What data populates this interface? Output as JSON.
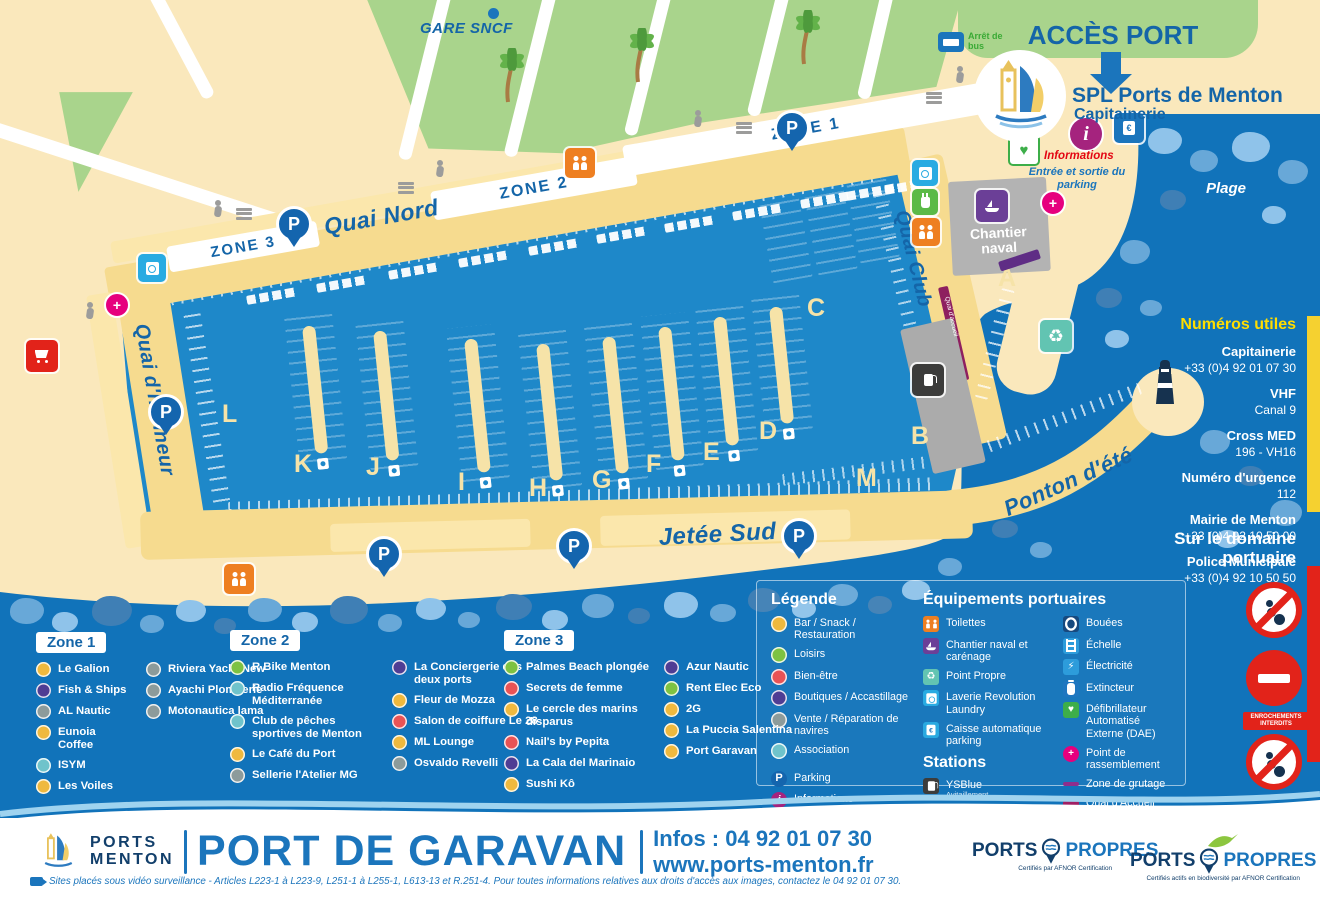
{
  "header": {
    "gare_sncf": "GARE SNCF",
    "acces_port": "ACCÈS PORT",
    "spl": "SPL Ports de Menton",
    "capitainerie": "Capitainerie",
    "arret_de_bus": "Arrêt de bus",
    "informations": "Informations",
    "entree_sortie": "Entrée et sortie du parking",
    "plage": "Plage"
  },
  "map": {
    "labels": {
      "quai_nord": "Quai Nord",
      "quai_honneur": "Quai d'honneur",
      "quai_club": "Quai Club",
      "jetee_sud": "Jetée Sud",
      "ponton_ete": "Ponton d'été",
      "chantier_naval": "Chantier naval",
      "quai_accueil": "Quai d'accueil",
      "zone1": "ZONE 1",
      "zone2": "ZONE 2",
      "zone3": "ZONE 3"
    },
    "pontoons": [
      "A",
      "B",
      "C",
      "D",
      "E",
      "F",
      "G",
      "H",
      "I",
      "J",
      "K",
      "L",
      "M"
    ]
  },
  "sidebar": {
    "numeros_utiles": {
      "title": "Numéros utiles",
      "entries": [
        {
          "label": "Capitainerie",
          "value": "+33 (0)4 92 01 07 30"
        },
        {
          "label": "VHF",
          "value": "Canal 9"
        },
        {
          "label": "Cross MED",
          "value": "196 - VH16"
        },
        {
          "label": "Numéro d'urgence",
          "value": "112"
        },
        {
          "label": "Mairie de Menton",
          "value": "+33 (0)4 92 10 50 00"
        },
        {
          "label": "Police Municipale",
          "value": "+33 (0)4 92 10 50 50"
        }
      ]
    },
    "domaine": {
      "title": "Sur le domaine portuaire",
      "signs": [
        {
          "name": "no-fishing",
          "label": ""
        },
        {
          "name": "no-entry",
          "label": "ENROCHEMENTS INTERDITS"
        },
        {
          "name": "no-rock-access",
          "label": ""
        }
      ]
    }
  },
  "category_colors": {
    "bar": "#EFB93E",
    "loisirs": "#7DC242",
    "bienetre": "#E95355",
    "boutiques": "#4F3D94",
    "vente": "#8C9B9B",
    "association": "#6FC3CB",
    "parking": "#1465AE",
    "info": "#A5237E"
  },
  "legend": {
    "title": "Légende",
    "categories": [
      {
        "label": "Bar / Snack / Restauration",
        "cat": "bar"
      },
      {
        "label": "Loisirs",
        "cat": "loisirs"
      },
      {
        "label": "Bien-être",
        "cat": "bienetre"
      },
      {
        "label": "Boutiques / Accastillage",
        "cat": "boutiques"
      },
      {
        "label": "Vente / Réparation de navires",
        "cat": "vente"
      },
      {
        "label": "Association",
        "cat": "association"
      }
    ],
    "extra": [
      {
        "label": "Parking",
        "type": "parking"
      },
      {
        "label": "Informations",
        "type": "info"
      },
      {
        "label": "Zone piétonne",
        "type": "pedestrian"
      }
    ],
    "equipements": {
      "title": "Équipements portuaires",
      "col1": [
        {
          "label": "Toilettes",
          "color": "#EE7F21",
          "icon": "toilets"
        },
        {
          "label": "Chantier naval et carénage",
          "color": "#6B3F97",
          "icon": "boat"
        },
        {
          "label": "Point Propre",
          "color": "#62C4B2",
          "icon": "recycle"
        },
        {
          "label": "Laverie Revolution Laundry",
          "color": "#29ABE2",
          "icon": "laundry"
        },
        {
          "label": "Caisse automatique parking",
          "color": "#2AA9E0",
          "icon": "card"
        }
      ],
      "col2": [
        {
          "label": "Bouées",
          "color": "#17497E",
          "icon": "ring"
        },
        {
          "label": "Échelle",
          "color": "#2D9CDB",
          "icon": "ladder"
        },
        {
          "label": "Électricité",
          "color": "#2D9CDB",
          "icon": "bolt"
        },
        {
          "label": "Extincteur",
          "color": "#1F77C0",
          "icon": "extinguisher"
        },
        {
          "label": "Défibrillateur Automatisé Externe (DAE)",
          "color": "#3DAE49",
          "icon": "heart"
        },
        {
          "label": "Point de rassemblement",
          "color": "#E6007E",
          "icon": "plus"
        },
        {
          "label": "Zone de grutage",
          "color": "#8E2E8C",
          "icon": "line"
        },
        {
          "label": "Quai d'Accueil",
          "color": "#A01F63",
          "icon": "line-thick"
        }
      ]
    },
    "stations": {
      "title": "Stations",
      "items": [
        {
          "label": "YSBlue",
          "sub": "Avitaillement",
          "color": "#3C3C3B",
          "icon": "fuel"
        },
        {
          "label": "Alizé Liberté",
          "sub": "Station de recharge",
          "color": "#5BBA47",
          "icon": "charge"
        }
      ]
    }
  },
  "zones": [
    {
      "chip": "Zone 1",
      "col1": [
        {
          "label": "Le Galion",
          "cat": "bar"
        },
        {
          "label": "Fish & Ships",
          "cat": "boutiques"
        },
        {
          "label": "AL Nautic",
          "cat": "vente"
        },
        {
          "label": "Eunoia Coffee",
          "cat": "bar"
        },
        {
          "label": "ISYM",
          "cat": "association"
        },
        {
          "label": "Les Voiles",
          "cat": "bar"
        }
      ],
      "col2": [
        {
          "label": "Riviera Yacht New",
          "cat": "vente"
        },
        {
          "label": "Ayachi Plomberie",
          "cat": "vente"
        },
        {
          "label": "Motonautica lama",
          "cat": "vente"
        }
      ]
    },
    {
      "chip": "Zone 2",
      "col1": [
        {
          "label": "R Bike Menton",
          "cat": "loisirs"
        },
        {
          "label": "Radio Fréquence Méditerranée",
          "cat": "association"
        },
        {
          "label": "Club de pêches sportives de Menton",
          "cat": "association"
        },
        {
          "label": "Le Café du Port",
          "cat": "bar"
        },
        {
          "label": "Sellerie l'Atelier MG",
          "cat": "vente"
        }
      ],
      "col2": [
        {
          "label": "La Conciergerie des deux ports",
          "cat": "boutiques"
        },
        {
          "label": "Fleur de Mozza",
          "cat": "bar"
        },
        {
          "label": "Salon de coiffure Le 28",
          "cat": "bienetre"
        },
        {
          "label": "ML Lounge",
          "cat": "bar"
        },
        {
          "label": "Osvaldo Revelli",
          "cat": "vente"
        }
      ]
    },
    {
      "chip": "Zone 3",
      "col1": [
        {
          "label": "Palmes Beach plongée",
          "cat": "loisirs"
        },
        {
          "label": "Secrets de femme",
          "cat": "bienetre"
        },
        {
          "label": "Le cercle des marins disparus",
          "cat": "bar"
        },
        {
          "label": "Nail's by Pepita",
          "cat": "bienetre"
        },
        {
          "label": "La Cala del Marinaio",
          "cat": "boutiques"
        },
        {
          "label": "Sushi Kô",
          "cat": "bar"
        }
      ],
      "col2": [
        {
          "label": "Azur Nautic",
          "cat": "boutiques"
        },
        {
          "label": "Rent Elec Eco",
          "cat": "loisirs"
        },
        {
          "label": "2G",
          "cat": "bar"
        },
        {
          "label": "La Puccia Salentina",
          "cat": "bar"
        },
        {
          "label": "Port Garavan",
          "cat": "bar"
        }
      ]
    }
  ],
  "footer": {
    "brand_line1": "PORTS",
    "brand_line2": "MENTON",
    "title": "PORT DE GARAVAN",
    "infos": "Infos : 04 92 01 07 30",
    "url": "www.ports-menton.fr",
    "pp1": {
      "left": "PORTS",
      "right": "PROPRES",
      "sub": "Certifiés par AFNOR Certification"
    },
    "pp2": {
      "left": "PORTS",
      "right": "PROPRES",
      "sub": "Certifiés actifs en biodiversité par AFNOR Certification"
    },
    "disclaimer": "Sites placés sous vidéo surveillance - Articles L223-1 à L223-9, L251-1 à L255-1, L613-13 et R.251-4. Pour toutes informations relatives aux droits d'accès aux images, contactez le 04 92 01 07 30."
  }
}
